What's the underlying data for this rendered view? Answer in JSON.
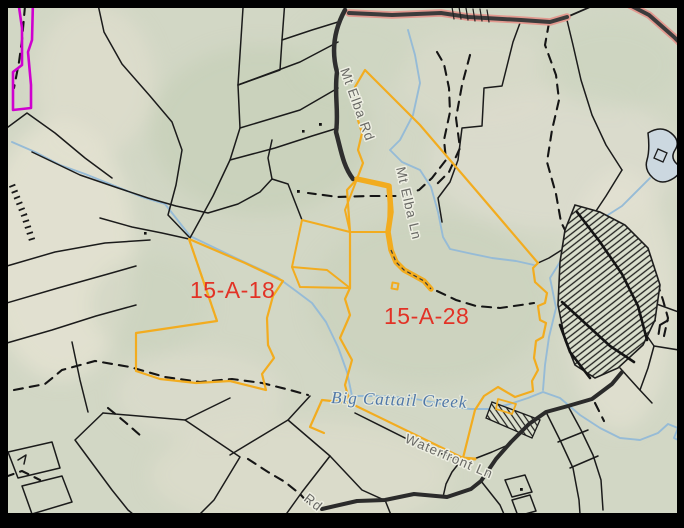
{
  "map": {
    "selected_parcels": [
      {
        "id": "15-A-18",
        "label": "15-A-18"
      },
      {
        "id": "15-A-28",
        "label": "15-A-28"
      }
    ],
    "road_labels": [
      {
        "name": "mt-elba-rd",
        "text": "Mt Elba Rd"
      },
      {
        "name": "mt-elba-ln",
        "text": "Mt Elba Ln"
      },
      {
        "name": "waterfront-ln",
        "text": "Waterfront Ln"
      },
      {
        "name": "rd-partial",
        "text": "Rd"
      }
    ],
    "water_labels": [
      {
        "name": "big-cattail-creek",
        "text": "Big Cattail Creek"
      }
    ],
    "colors": {
      "background_sage": "#d3d7c6",
      "terrain_tan": "#e4e2d2",
      "parcel_line_black": "#1b1b1b",
      "highlight_yellow": "#f2ac1f",
      "parcel_label_red": "#e23226",
      "boundary_magenta": "#cf00cf",
      "creek_blue": "#96bbd6",
      "road_dark": "#333333",
      "highway_casing_salmon": "#e2998f",
      "road_label_gray": "#6a6a66",
      "water_label_blue": "#4f77a8",
      "frame_black": "#000000"
    }
  }
}
